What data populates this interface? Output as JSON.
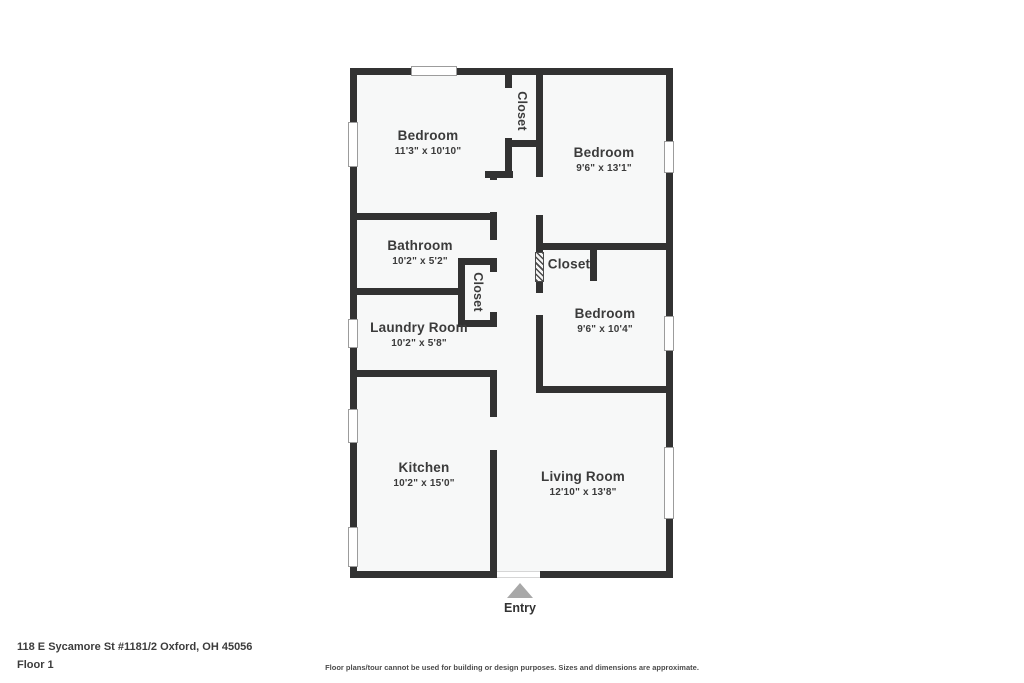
{
  "plan": {
    "address": "118 E Sycamore St #1181/2 Oxford, OH 45056",
    "floor_label": "Floor 1",
    "disclaimer": "Floor plans/tour cannot be used for building or design purposes. Sizes and dimensions are approximate.",
    "entry_label": "Entry",
    "colors": {
      "wall": "#323232",
      "floor": "#f7f8f8",
      "label": "#3b3b3b",
      "arrow": "#a8a8a8"
    },
    "rooms": [
      {
        "id": "bedroom-1",
        "name": "Bedroom",
        "dims": "11'3\" x 10'10\"",
        "cx": 428,
        "cy": 143,
        "vertical": false
      },
      {
        "id": "closet-top",
        "name": "Closet",
        "dims": "",
        "cx": 521,
        "cy": 111,
        "vertical": true
      },
      {
        "id": "bedroom-2",
        "name": "Bedroom",
        "dims": "9'6\" x 13'1\"",
        "cx": 604,
        "cy": 160,
        "vertical": false
      },
      {
        "id": "bathroom",
        "name": "Bathroom",
        "dims": "10'2\" x 5'2\"",
        "cx": 420,
        "cy": 253,
        "vertical": false
      },
      {
        "id": "closet-hall",
        "name": "Closet",
        "dims": "",
        "cx": 477,
        "cy": 292,
        "vertical": true
      },
      {
        "id": "closet-bedroom",
        "name": "Closet",
        "dims": "",
        "cx": 569,
        "cy": 265,
        "vertical": false
      },
      {
        "id": "bedroom-3",
        "name": "Bedroom",
        "dims": "9'6\" x 10'4\"",
        "cx": 605,
        "cy": 321,
        "vertical": false
      },
      {
        "id": "laundry-room",
        "name": "Laundry Room",
        "dims": "10'2\" x 5'8\"",
        "cx": 419,
        "cy": 335,
        "vertical": false
      },
      {
        "id": "kitchen",
        "name": "Kitchen",
        "dims": "10'2\" x 15'0\"",
        "cx": 424,
        "cy": 475,
        "vertical": false
      },
      {
        "id": "living-room",
        "name": "Living Room",
        "dims": "12'10\" x 13'8\"",
        "cx": 583,
        "cy": 484,
        "vertical": false
      }
    ],
    "geometry": {
      "floor": [
        350,
        68,
        323,
        510
      ],
      "walls": [
        {
          "name": "outer-wall-top",
          "r": [
            350,
            68,
            323,
            7
          ]
        },
        {
          "name": "outer-wall-bottom",
          "r": [
            350,
            571,
            323,
            7
          ]
        },
        {
          "name": "outer-wall-left",
          "r": [
            350,
            68,
            7,
            510
          ]
        },
        {
          "name": "outer-wall-right",
          "r": [
            666,
            68,
            7,
            510
          ]
        },
        {
          "name": "closet-top-left-wall",
          "r": [
            505,
            75,
            7,
            103
          ]
        },
        {
          "name": "closet-top-bottom-wall",
          "r": [
            505,
            140,
            38,
            7
          ]
        },
        {
          "name": "hallway-east-wall",
          "r": [
            536,
            75,
            7,
            318
          ]
        },
        {
          "name": "bedroom1-south-wall",
          "r": [
            350,
            213,
            147,
            7
          ]
        },
        {
          "name": "hall-recess-wall",
          "r": [
            485,
            171,
            28,
            7
          ]
        },
        {
          "name": "bathroom-south-wall",
          "r": [
            350,
            288,
            115,
            7
          ]
        },
        {
          "name": "hall-closet-west-wall",
          "r": [
            458,
            258,
            7,
            69
          ]
        },
        {
          "name": "hall-closet-top-wall",
          "r": [
            458,
            258,
            39,
            7
          ]
        },
        {
          "name": "hall-closet-bottom-wall",
          "r": [
            458,
            320,
            39,
            7
          ]
        },
        {
          "name": "laundry-south-wall",
          "r": [
            350,
            370,
            147,
            7
          ]
        },
        {
          "name": "hallway-west-wall",
          "r": [
            490,
            178,
            7,
            400
          ]
        },
        {
          "name": "bedroom2-south-wall",
          "r": [
            536,
            243,
            137,
            7
          ]
        },
        {
          "name": "bedroom-closet-east-wall",
          "r": [
            590,
            250,
            7,
            31
          ]
        },
        {
          "name": "bedroom3-south-wall",
          "r": [
            536,
            386,
            137,
            7
          ]
        }
      ],
      "gaps": [
        {
          "name": "closet-top-door",
          "r": [
            505,
            88,
            7,
            50
          ]
        },
        {
          "name": "bedroom1-door",
          "r": [
            490,
            180,
            7,
            32
          ]
        },
        {
          "name": "bathroom-door",
          "r": [
            490,
            240,
            7,
            18
          ]
        },
        {
          "name": "hall-closet-door",
          "r": [
            490,
            272,
            7,
            40
          ]
        },
        {
          "name": "laundry-opening",
          "r": [
            490,
            327,
            7,
            43
          ]
        },
        {
          "name": "kitchen-door",
          "r": [
            490,
            417,
            7,
            33
          ]
        },
        {
          "name": "bedroom2-door",
          "r": [
            536,
            177,
            7,
            38
          ]
        },
        {
          "name": "bedroom3-door",
          "r": [
            536,
            293,
            7,
            22
          ]
        },
        {
          "name": "entry-opening",
          "r": [
            497,
            571,
            43,
            7
          ]
        }
      ],
      "hatches": [
        {
          "name": "bedroom-closet-louver-door",
          "r": [
            535,
            252,
            9,
            30
          ]
        }
      ],
      "windows": [
        {
          "name": "window-top",
          "r": [
            411,
            66,
            46,
            10
          ]
        },
        {
          "name": "window-left-1",
          "r": [
            348,
            122,
            10,
            45
          ]
        },
        {
          "name": "window-left-2",
          "r": [
            348,
            319,
            10,
            29
          ]
        },
        {
          "name": "window-left-3",
          "r": [
            348,
            409,
            10,
            34
          ]
        },
        {
          "name": "window-left-4",
          "r": [
            348,
            527,
            10,
            40
          ]
        },
        {
          "name": "window-right-1",
          "r": [
            664,
            141,
            10,
            32
          ]
        },
        {
          "name": "window-right-2",
          "r": [
            664,
            316,
            10,
            35
          ]
        },
        {
          "name": "window-right-3",
          "r": [
            664,
            447,
            10,
            72
          ]
        }
      ]
    }
  }
}
